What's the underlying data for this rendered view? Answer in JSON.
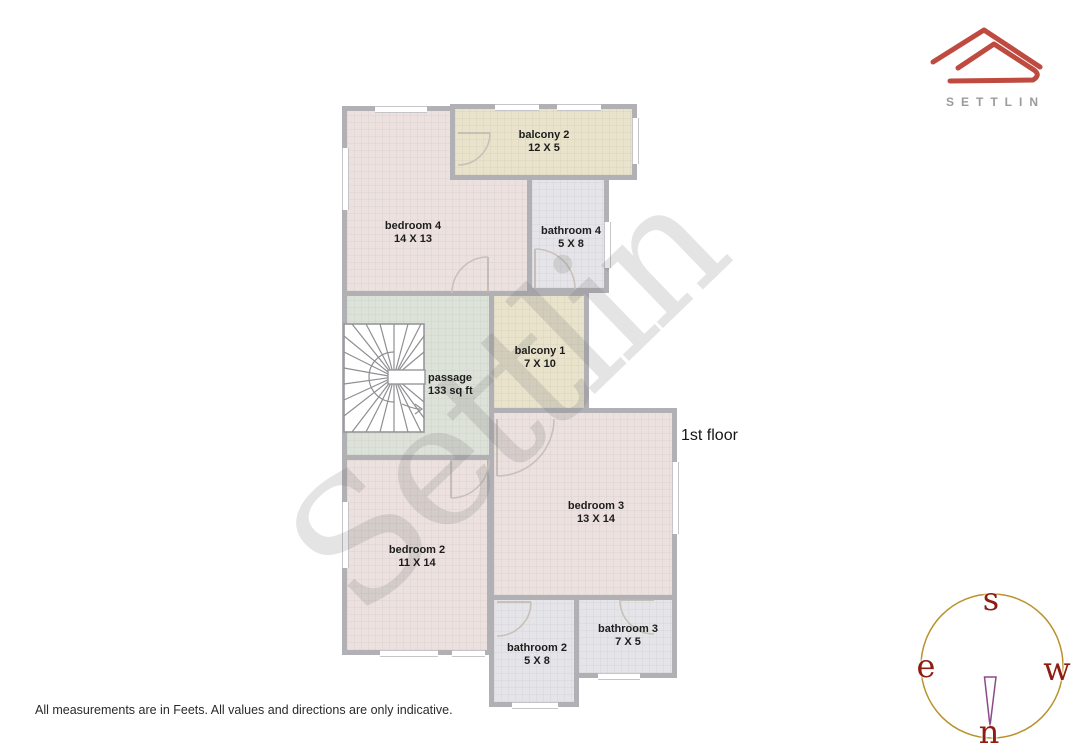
{
  "brand": {
    "name": "SETTLIN"
  },
  "floor": {
    "label": "1st floor"
  },
  "watermark": {
    "text": "Settlin"
  },
  "disclaimer": "All measurements are in Feets. All values and directions are only indicative.",
  "rooms": [
    {
      "name": "bedroom 4",
      "size": "14 X 13"
    },
    {
      "name": "balcony 2",
      "size": "12 X 5"
    },
    {
      "name": "bathroom 4",
      "size": "5 X 8"
    },
    {
      "name": "passage",
      "size": "133 sq ft"
    },
    {
      "name": "balcony 1",
      "size": "7 X 10"
    },
    {
      "name": "bedroom 3",
      "size": "13 X 14"
    },
    {
      "name": "bedroom 2",
      "size": "11 X 14"
    },
    {
      "name": "bathroom 2",
      "size": "5 X 8"
    },
    {
      "name": "bathroom 3",
      "size": "7 X 5"
    }
  ],
  "compass": {
    "top": "s",
    "left": "e",
    "right": "w",
    "bottom": "n"
  },
  "colors": {
    "wall": "#b1b0b5",
    "bedroom_fill": "#ece1de",
    "balcony_fill": "#e9e3cc",
    "bathroom_fill": "#e5e5e9",
    "passage_fill": "#dde2d9",
    "brand_red": "#bf4b40",
    "brand_gray": "#9b9b9b",
    "compass_circle": "#b8922c",
    "compass_letters": "#8e1c10",
    "compass_needle": "#8d4a8a"
  }
}
